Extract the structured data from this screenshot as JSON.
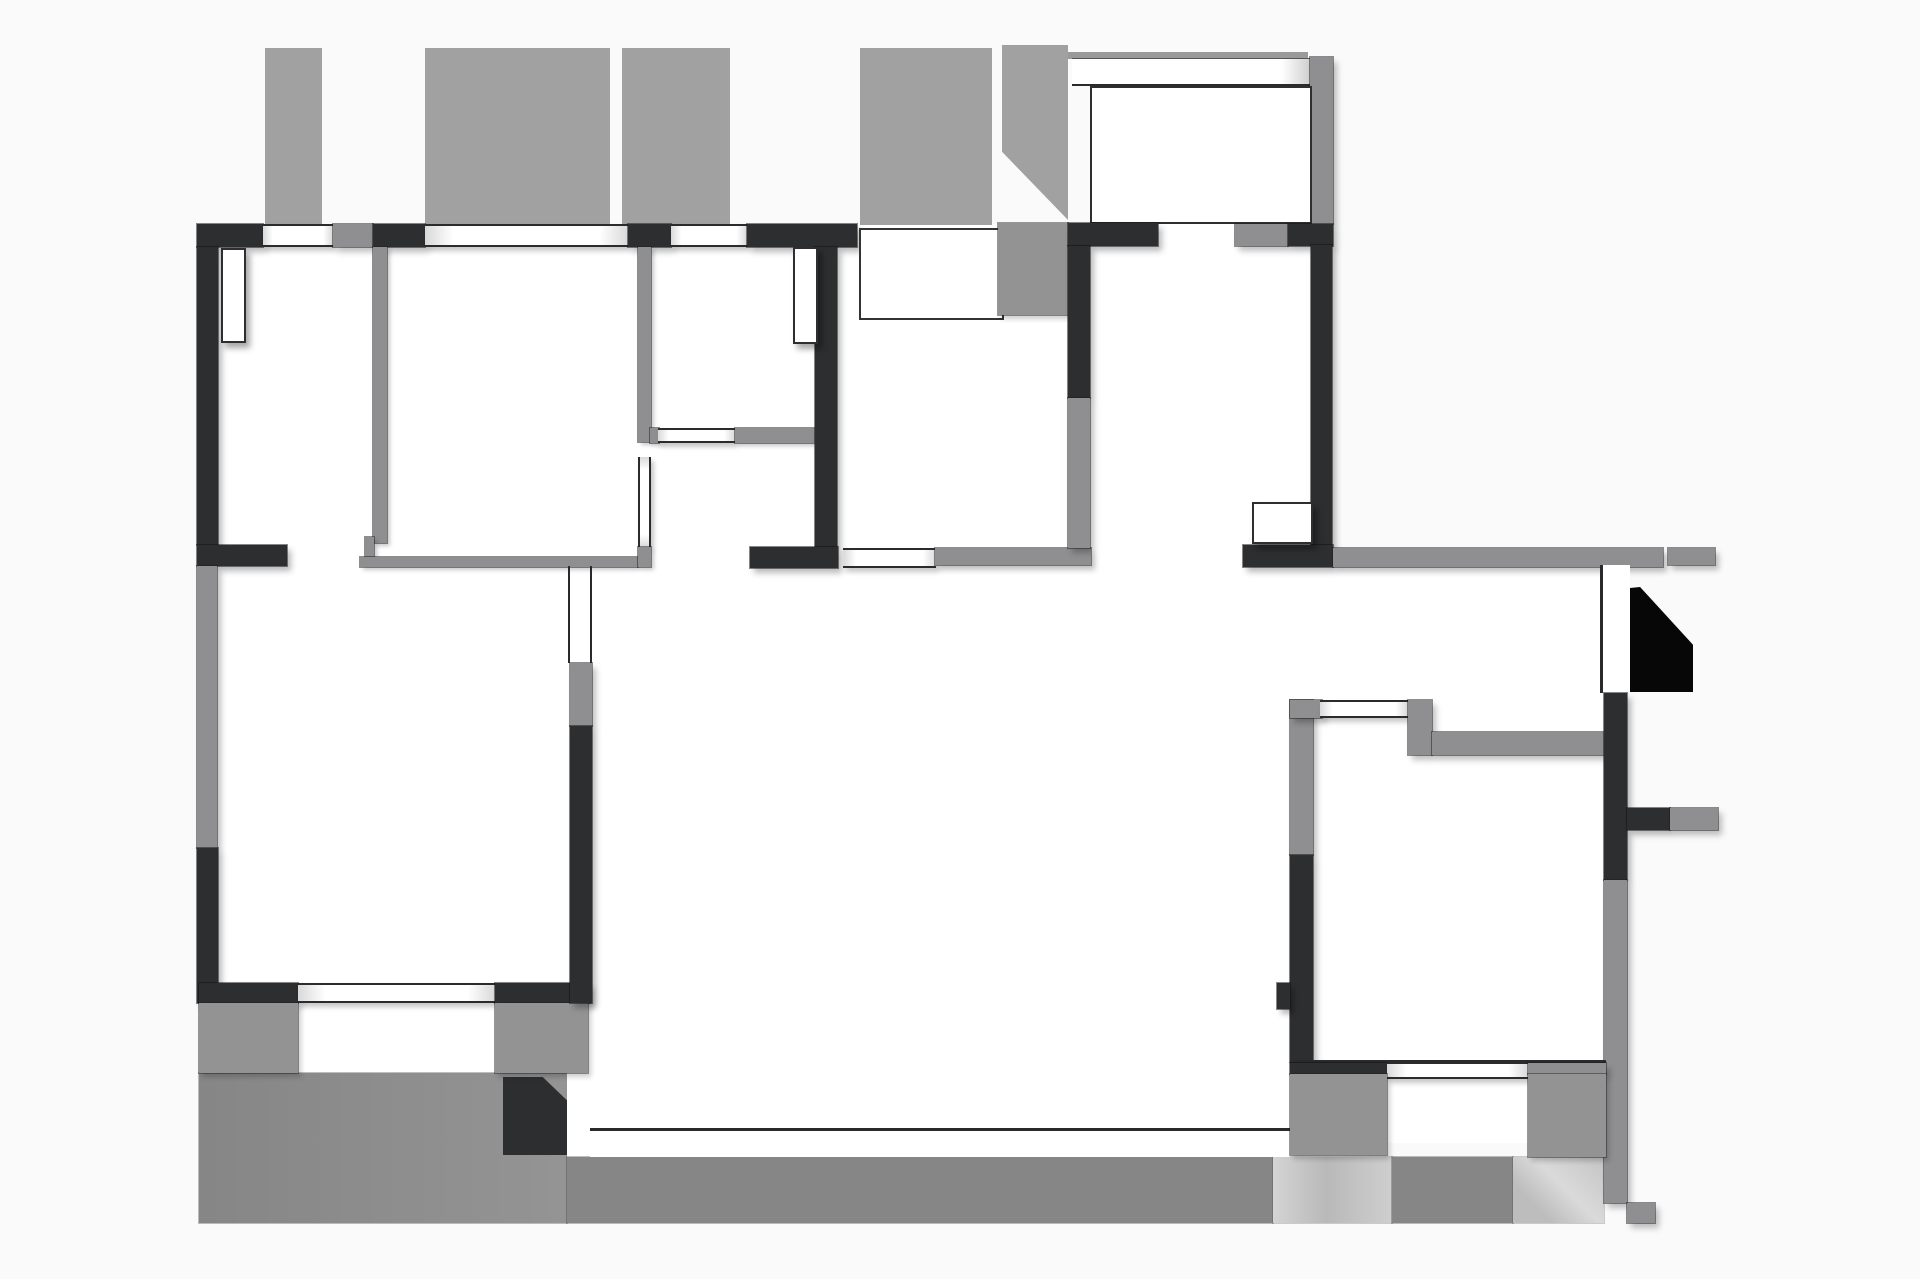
{
  "title": "apartment-floor-plan",
  "canvas": {
    "width": 1920,
    "height": 1279,
    "background_color": "#fafafa"
  },
  "palette": {
    "wall_dark": "#2d2e30",
    "wall_gray": "#8f8f91",
    "stripe_gray": "#a1a1a1",
    "block_gray": "#939393",
    "terrace_gray": "#8d8d8d",
    "strip_medium": "#868686",
    "strip_light": "#c9c9c9",
    "entry_step_black": "#070707",
    "room_white": "#ffffff",
    "line_dark": "#2a2a2c"
  },
  "elements": [
    {
      "id": "room-top-band",
      "kind": "room",
      "x": 197,
      "y": 224,
      "w": 1136,
      "h": 324
    },
    {
      "id": "room-bedroom-bottom-left",
      "kind": "room",
      "x": 197,
      "y": 545,
      "w": 395,
      "h": 458
    },
    {
      "id": "room-living",
      "kind": "room",
      "x": 560,
      "y": 548,
      "w": 730,
      "h": 609
    },
    {
      "id": "room-vestibule",
      "kind": "room",
      "x": 1243,
      "y": 548,
      "w": 361,
      "h": 155
    },
    {
      "id": "room-kitchen",
      "kind": "room",
      "x": 1290,
      "y": 693,
      "w": 337,
      "h": 385
    },
    {
      "id": "room-lightwell-row",
      "kind": "room",
      "x": 199,
      "y": 983,
      "w": 390,
      "h": 90
    },
    {
      "id": "room-kitchen-window-bay",
      "kind": "room",
      "x": 1387,
      "y": 1078,
      "w": 141,
      "h": 65
    },
    {
      "id": "upper-stripe-1",
      "kind": "stripe",
      "x": 265,
      "y": 48,
      "w": 57,
      "h": 177
    },
    {
      "id": "upper-stripe-2",
      "kind": "stripe",
      "x": 425,
      "y": 48,
      "w": 185,
      "h": 177
    },
    {
      "id": "upper-stripe-3",
      "kind": "stripe",
      "x": 622,
      "y": 48,
      "w": 108,
      "h": 177
    },
    {
      "id": "upper-stripe-4",
      "kind": "stripe",
      "x": 860,
      "y": 48,
      "w": 132,
      "h": 177
    },
    {
      "id": "porch-left-column",
      "kind": "pent-gray",
      "x": 1002,
      "y": 45,
      "w": 66,
      "h": 175,
      "clip": "polygon(0 0,100% 0,100% 100%,0 61%)"
    },
    {
      "id": "porch-top-strip",
      "kind": "porch-strip",
      "x": 1068,
      "y": 52,
      "w": 240,
      "h": 7
    },
    {
      "id": "porch-top-wall",
      "kind": "porch-band",
      "x": 1072,
      "y": 58,
      "w": 238,
      "h": 28
    },
    {
      "id": "porch-right-wall",
      "kind": "wall-gray",
      "x": 1310,
      "y": 57,
      "w": 23,
      "h": 167
    },
    {
      "id": "porch-interior",
      "kind": "room-outlined",
      "x": 1090,
      "y": 86,
      "w": 222,
      "h": 138
    },
    {
      "id": "terrace-slab",
      "kind": "terrace",
      "x": 199,
      "y": 1073,
      "w": 368,
      "h": 150
    },
    {
      "id": "terrace-step-dark",
      "kind": "sq-dark",
      "x": 503,
      "y": 1077,
      "w": 64,
      "h": 78,
      "clip": "polygon(0 0,62% 0,100% 30%,100% 100%,0 100%)"
    },
    {
      "id": "terrace-white-channel",
      "kind": "white-patch",
      "x": 567,
      "y": 1073,
      "w": 23,
      "h": 84
    },
    {
      "id": "bottom-strip-1",
      "kind": "strip-med",
      "x": 567,
      "y": 1157,
      "w": 706,
      "h": 66
    },
    {
      "id": "bottom-strip-2",
      "kind": "strip-light",
      "x": 1273,
      "y": 1157,
      "w": 119,
      "h": 66
    },
    {
      "id": "bottom-strip-3",
      "kind": "strip-med",
      "x": 1392,
      "y": 1157,
      "w": 121,
      "h": 66
    },
    {
      "id": "bottom-strip-4",
      "kind": "strip-diag",
      "x": 1513,
      "y": 1157,
      "w": 91,
      "h": 66
    },
    {
      "id": "living-bottom-white-band",
      "kind": "white-patch",
      "x": 590,
      "y": 1131,
      "w": 700,
      "h": 26
    },
    {
      "id": "living-bottom-line",
      "kind": "line-h",
      "x": 590,
      "y": 1128,
      "w": 700,
      "h": 3
    },
    {
      "id": "top-wall-seg-1",
      "kind": "wall-dark",
      "x": 197,
      "y": 224,
      "w": 66,
      "h": 23
    },
    {
      "id": "top-wall-window-1",
      "kind": "window-h",
      "x": 263,
      "y": 224,
      "w": 70,
      "h": 23
    },
    {
      "id": "top-wall-post",
      "kind": "wall-gray",
      "x": 333,
      "y": 224,
      "w": 40,
      "h": 23
    },
    {
      "id": "top-wall-seg-2",
      "kind": "wall-dark",
      "x": 373,
      "y": 224,
      "w": 52,
      "h": 23
    },
    {
      "id": "top-wall-window-2",
      "kind": "window-h",
      "x": 425,
      "y": 224,
      "w": 203,
      "h": 23
    },
    {
      "id": "top-wall-seg-3",
      "kind": "wall-dark",
      "x": 628,
      "y": 224,
      "w": 43,
      "h": 23
    },
    {
      "id": "top-wall-window-3",
      "kind": "window-h",
      "x": 671,
      "y": 224,
      "w": 76,
      "h": 23
    },
    {
      "id": "top-wall-seg-4",
      "kind": "wall-dark",
      "x": 747,
      "y": 224,
      "w": 110,
      "h": 23
    },
    {
      "id": "entry-alcove",
      "kind": "alcove",
      "x": 859,
      "y": 228,
      "w": 145,
      "h": 92
    },
    {
      "id": "entry-gray-square",
      "kind": "block-gray",
      "x": 998,
      "y": 223,
      "w": 70,
      "h": 92
    },
    {
      "id": "top-wall-seg-5",
      "kind": "wall-dark",
      "x": 1068,
      "y": 223,
      "w": 90,
      "h": 23
    },
    {
      "id": "top-wall-gray-block",
      "kind": "wall-gray",
      "x": 1235,
      "y": 224,
      "w": 53,
      "h": 22
    },
    {
      "id": "top-wall-seg-6",
      "kind": "wall-dark",
      "x": 1288,
      "y": 224,
      "w": 45,
      "h": 22
    },
    {
      "id": "left-wall-upper",
      "kind": "wall-dark",
      "x": 197,
      "y": 247,
      "w": 21,
      "h": 298
    },
    {
      "id": "left-wall-stub",
      "kind": "wall-dark",
      "x": 197,
      "y": 545,
      "w": 90,
      "h": 21
    },
    {
      "id": "left-wall-mid-gray",
      "kind": "wall-gray",
      "x": 197,
      "y": 566,
      "w": 20,
      "h": 282
    },
    {
      "id": "left-wall-lower",
      "kind": "wall-dark",
      "x": 197,
      "y": 848,
      "w": 21,
      "h": 155
    },
    {
      "id": "bottom-left-wall-1",
      "kind": "wall-dark",
      "x": 199,
      "y": 983,
      "w": 99,
      "h": 20
    },
    {
      "id": "bottom-left-window",
      "kind": "window-h",
      "x": 298,
      "y": 983,
      "w": 197,
      "h": 20
    },
    {
      "id": "bottom-left-wall-2",
      "kind": "wall-dark",
      "x": 495,
      "y": 983,
      "w": 95,
      "h": 20
    },
    {
      "id": "lightwell-block-left",
      "kind": "block-gray",
      "x": 199,
      "y": 1003,
      "w": 99,
      "h": 70
    },
    {
      "id": "lightwell-block-right",
      "kind": "block-gray",
      "x": 495,
      "y": 1003,
      "w": 93,
      "h": 70
    },
    {
      "id": "divider-bed1-bed2",
      "kind": "wall-thin",
      "x": 373,
      "y": 247,
      "w": 14,
      "h": 296
    },
    {
      "id": "divider-notch",
      "kind": "wall-thin",
      "x": 365,
      "y": 537,
      "w": 9,
      "h": 20
    },
    {
      "id": "bed2-bottom-wall",
      "kind": "wall-thin",
      "x": 360,
      "y": 557,
      "w": 278,
      "h": 10
    },
    {
      "id": "bed2-right-wall-upper",
      "kind": "wall-thin",
      "x": 638,
      "y": 247,
      "w": 13,
      "h": 195
    },
    {
      "id": "bed2-right-wall-stub",
      "kind": "wall-thin",
      "x": 650,
      "y": 428,
      "w": 9,
      "h": 15
    },
    {
      "id": "bed2-right-wall-opening",
      "kind": "window-v",
      "x": 638,
      "y": 457,
      "w": 13,
      "h": 90
    },
    {
      "id": "bed2-right-wall-foot",
      "kind": "wall-thin",
      "x": 638,
      "y": 547,
      "w": 13,
      "h": 20
    },
    {
      "id": "bath2-closet-window",
      "kind": "window-h",
      "x": 658,
      "y": 428,
      "w": 77,
      "h": 15
    },
    {
      "id": "bath2-closet-wall",
      "kind": "wall-thin",
      "x": 735,
      "y": 428,
      "w": 80,
      "h": 15
    },
    {
      "id": "center-wall-vertical",
      "kind": "wall-dark",
      "x": 815,
      "y": 247,
      "w": 22,
      "h": 300
    },
    {
      "id": "center-wall-bottom",
      "kind": "wall-dark",
      "x": 750,
      "y": 547,
      "w": 88,
      "h": 21
    },
    {
      "id": "foyer-bottom-window",
      "kind": "window-h",
      "x": 843,
      "y": 548,
      "w": 93,
      "h": 20
    },
    {
      "id": "foyer-bottom-wall",
      "kind": "wall-gray",
      "x": 935,
      "y": 548,
      "w": 156,
      "h": 17
    },
    {
      "id": "foyer-right-wall-dark",
      "kind": "wall-dark",
      "x": 1068,
      "y": 246,
      "w": 22,
      "h": 152
    },
    {
      "id": "foyer-right-wall-gray",
      "kind": "wall-gray",
      "x": 1068,
      "y": 398,
      "w": 22,
      "h": 150
    },
    {
      "id": "hall-right-wall",
      "kind": "wall-dark",
      "x": 1311,
      "y": 245,
      "w": 21,
      "h": 302
    },
    {
      "id": "hall-bottom-wall",
      "kind": "wall-dark",
      "x": 1243,
      "y": 545,
      "w": 90,
      "h": 22
    },
    {
      "id": "vestibule-top-wall",
      "kind": "wall-gray",
      "x": 1333,
      "y": 548,
      "w": 330,
      "h": 19
    },
    {
      "id": "right-ledge-top",
      "kind": "wall-gray",
      "x": 1668,
      "y": 548,
      "w": 47,
      "h": 17
    },
    {
      "id": "vestibule-right-line",
      "kind": "line-v",
      "x": 1600,
      "y": 565,
      "w": 3,
      "h": 128
    },
    {
      "id": "vestibule-right-channel",
      "kind": "white-patch",
      "x": 1603,
      "y": 565,
      "w": 27,
      "h": 128
    },
    {
      "id": "entry-step-black",
      "kind": "black-step",
      "x": 1630,
      "y": 587,
      "w": 63,
      "h": 105,
      "clip": "polygon(0 1%,16% 0,100% 55%,100% 100%,0 100%)"
    },
    {
      "id": "kitchen-left-wall-gray",
      "kind": "wall-gray",
      "x": 1290,
      "y": 700,
      "w": 23,
      "h": 155
    },
    {
      "id": "kitchen-left-wall-dark",
      "kind": "wall-dark",
      "x": 1290,
      "y": 855,
      "w": 23,
      "h": 207
    },
    {
      "id": "kitchen-left-tab",
      "kind": "wall-dark",
      "x": 1277,
      "y": 983,
      "w": 13,
      "h": 26
    },
    {
      "id": "kitchen-top-wall-left",
      "kind": "wall-gray",
      "x": 1290,
      "y": 700,
      "w": 32,
      "h": 18
    },
    {
      "id": "kitchen-top-window",
      "kind": "window-h",
      "x": 1320,
      "y": 700,
      "w": 88,
      "h": 18
    },
    {
      "id": "kitchen-top-step",
      "kind": "wall-gray",
      "x": 1408,
      "y": 700,
      "w": 24,
      "h": 55
    },
    {
      "id": "kitchen-top-wall-right",
      "kind": "wall-gray",
      "x": 1432,
      "y": 732,
      "w": 174,
      "h": 23
    },
    {
      "id": "kitchen-right-wall-dark",
      "kind": "wall-dark",
      "x": 1604,
      "y": 693,
      "w": 23,
      "h": 187
    },
    {
      "id": "right-ledge-mid-dark",
      "kind": "wall-dark",
      "x": 1627,
      "y": 808,
      "w": 43,
      "h": 22
    },
    {
      "id": "right-ledge-mid-gray",
      "kind": "wall-gray",
      "x": 1670,
      "y": 808,
      "w": 48,
      "h": 22
    },
    {
      "id": "kitchen-right-wall-gray",
      "kind": "wall-gray",
      "x": 1604,
      "y": 880,
      "w": 23,
      "h": 323
    },
    {
      "id": "kitchen-bottom-jag-tab",
      "kind": "wall-gray",
      "x": 1627,
      "y": 1203,
      "w": 28,
      "h": 20
    },
    {
      "id": "kitchen-bottom-line",
      "kind": "line-h",
      "x": 1290,
      "y": 1060,
      "w": 316,
      "h": 3
    },
    {
      "id": "kitchen-bottom-wall-left",
      "kind": "wall-dark",
      "x": 1290,
      "y": 1063,
      "w": 97,
      "h": 11
    },
    {
      "id": "kitchen-bottom-window",
      "kind": "window-h",
      "x": 1387,
      "y": 1062,
      "w": 141,
      "h": 17
    },
    {
      "id": "kitchen-bottom-wall-right",
      "kind": "wall-gray",
      "x": 1528,
      "y": 1063,
      "w": 78,
      "h": 11
    },
    {
      "id": "kitchen-bottom-block-left",
      "kind": "block-gray",
      "x": 1290,
      "y": 1074,
      "w": 97,
      "h": 81
    },
    {
      "id": "kitchen-bottom-block-right",
      "kind": "block-gray",
      "x": 1528,
      "y": 1074,
      "w": 78,
      "h": 83
    },
    {
      "id": "bed3-door-line-left",
      "kind": "line-v",
      "x": 568,
      "y": 566,
      "w": 2,
      "h": 97
    },
    {
      "id": "bed3-door-line-right",
      "kind": "line-v",
      "x": 590,
      "y": 566,
      "w": 2,
      "h": 97
    },
    {
      "id": "bed3-right-wall-gray",
      "kind": "wall-gray",
      "x": 570,
      "y": 663,
      "w": 22,
      "h": 63
    },
    {
      "id": "bed3-right-wall-dark",
      "kind": "wall-dark",
      "x": 570,
      "y": 726,
      "w": 22,
      "h": 277
    },
    {
      "id": "pilaster-bedroom1",
      "kind": "leaf",
      "x": 221,
      "y": 248,
      "w": 25,
      "h": 95
    },
    {
      "id": "pilaster-bathroom",
      "kind": "leaf",
      "x": 793,
      "y": 247,
      "w": 25,
      "h": 97
    },
    {
      "id": "hall-door-leaf",
      "kind": "leaf",
      "x": 1252,
      "y": 502,
      "w": 61,
      "h": 42
    }
  ]
}
